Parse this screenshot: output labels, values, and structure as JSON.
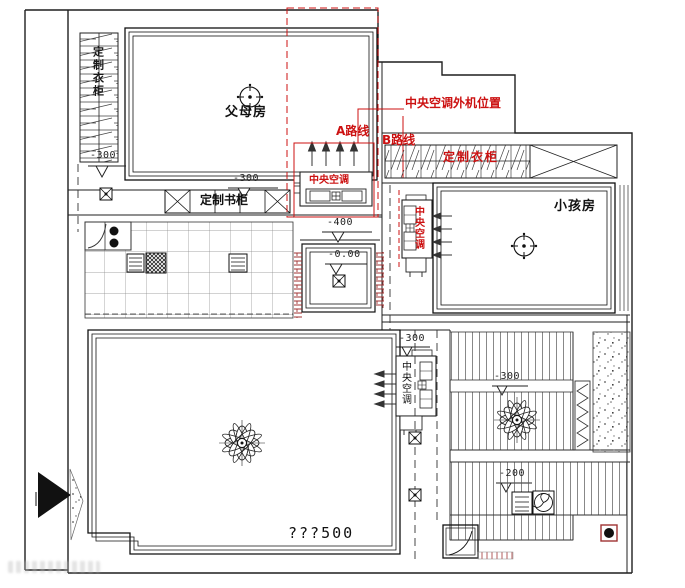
{
  "annotations": {
    "ac_outdoor_position": "中央空调外机位置",
    "route_a": "A路线",
    "route_b": "B路线"
  },
  "rooms": {
    "parents_room": "父母房",
    "kids_room": "小孩房"
  },
  "furniture": {
    "wardrobe_left": "定制衣柜",
    "wardrobe_kids": "定制衣柜",
    "bookcase": "定制书柜"
  },
  "equipment": {
    "ac_top": "中央空调",
    "ac_kids": "中央空调",
    "ac_living": "中央空调"
  },
  "levels": {
    "wardrobe_side": "-300",
    "bookcase_top": "-300",
    "hall_upper": "-400",
    "hall_zero": "-0.00",
    "corridor": "-300",
    "bedroom_mid": "-300",
    "bathroom": "-200"
  },
  "notes": {
    "living_dim": "???500"
  },
  "colors": {
    "line": "#1f1f1f",
    "annotation_red": "#cc1111",
    "brick_red": "#a03333"
  }
}
